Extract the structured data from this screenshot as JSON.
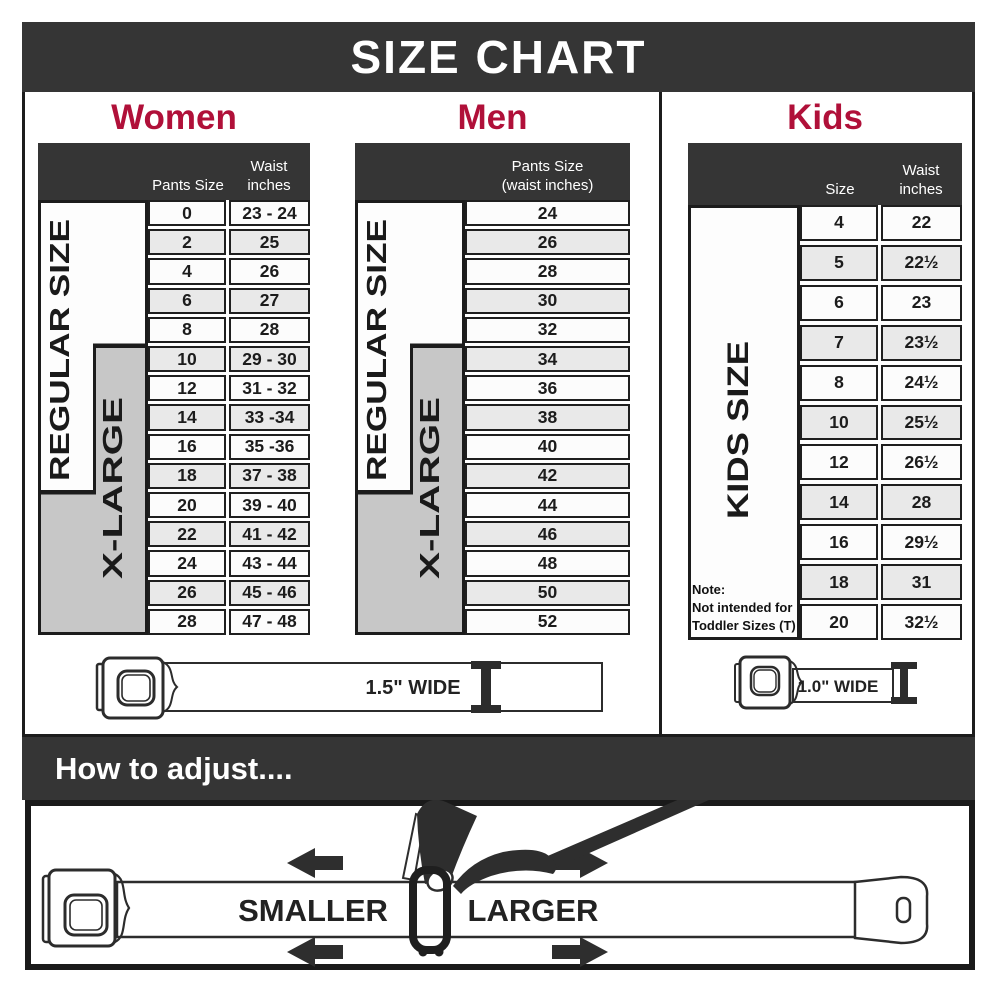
{
  "banner": {
    "title": "SIZE CHART"
  },
  "colors": {
    "accent": "#b01039",
    "dark": "#353535",
    "band_gray": "#c7c7c7"
  },
  "sections": {
    "women": {
      "heading": "Women",
      "header": {
        "col_size": "Pants Size",
        "col_waist_l1": "Waist",
        "col_waist_l2": "inches"
      },
      "bands": {
        "regular": "REGULAR SIZE",
        "xlarge": "X-LARGE"
      },
      "rows": [
        {
          "size": "0",
          "waist": "23 - 24"
        },
        {
          "size": "2",
          "waist": "25"
        },
        {
          "size": "4",
          "waist": "26"
        },
        {
          "size": "6",
          "waist": "27"
        },
        {
          "size": "8",
          "waist": "28"
        },
        {
          "size": "10",
          "waist": "29 - 30"
        },
        {
          "size": "12",
          "waist": "31 - 32"
        },
        {
          "size": "14",
          "waist": "33 -34"
        },
        {
          "size": "16",
          "waist": "35 -36"
        },
        {
          "size": "18",
          "waist": "37 - 38"
        },
        {
          "size": "20",
          "waist": "39 - 40"
        },
        {
          "size": "22",
          "waist": "41 - 42"
        },
        {
          "size": "24",
          "waist": "43 - 44"
        },
        {
          "size": "26",
          "waist": "45 - 46"
        },
        {
          "size": "28",
          "waist": "47 - 48"
        }
      ]
    },
    "men": {
      "heading": "Men",
      "header": {
        "l1": "Pants Size",
        "l2": "(waist inches)"
      },
      "bands": {
        "regular": "REGULAR SIZE",
        "xlarge": "X-LARGE"
      },
      "rows": [
        "24",
        "26",
        "28",
        "30",
        "32",
        "34",
        "36",
        "38",
        "40",
        "42",
        "44",
        "46",
        "48",
        "50",
        "52"
      ]
    },
    "kids": {
      "heading": "Kids",
      "header": {
        "col_size": "Size",
        "col_waist_l1": "Waist",
        "col_waist_l2": "inches"
      },
      "band": "KIDS SIZE",
      "note": {
        "l1": "Note:",
        "l2": "Not intended for",
        "l3": "Toddler Sizes (T)"
      },
      "rows": [
        {
          "size": "4",
          "waist": "22"
        },
        {
          "size": "5",
          "waist": "22½"
        },
        {
          "size": "6",
          "waist": "23"
        },
        {
          "size": "7",
          "waist": "23½"
        },
        {
          "size": "8",
          "waist": "24½"
        },
        {
          "size": "10",
          "waist": "25½"
        },
        {
          "size": "12",
          "waist": "26½"
        },
        {
          "size": "14",
          "waist": "28"
        },
        {
          "size": "16",
          "waist": "29½"
        },
        {
          "size": "18",
          "waist": "31"
        },
        {
          "size": "20",
          "waist": "32½"
        }
      ]
    }
  },
  "belts": {
    "adult_width_label": "1.5\" WIDE",
    "kids_width_label": "1.0\" WIDE"
  },
  "adjust": {
    "heading": "How to adjust....",
    "smaller": "SMALLER",
    "larger": "LARGER"
  }
}
